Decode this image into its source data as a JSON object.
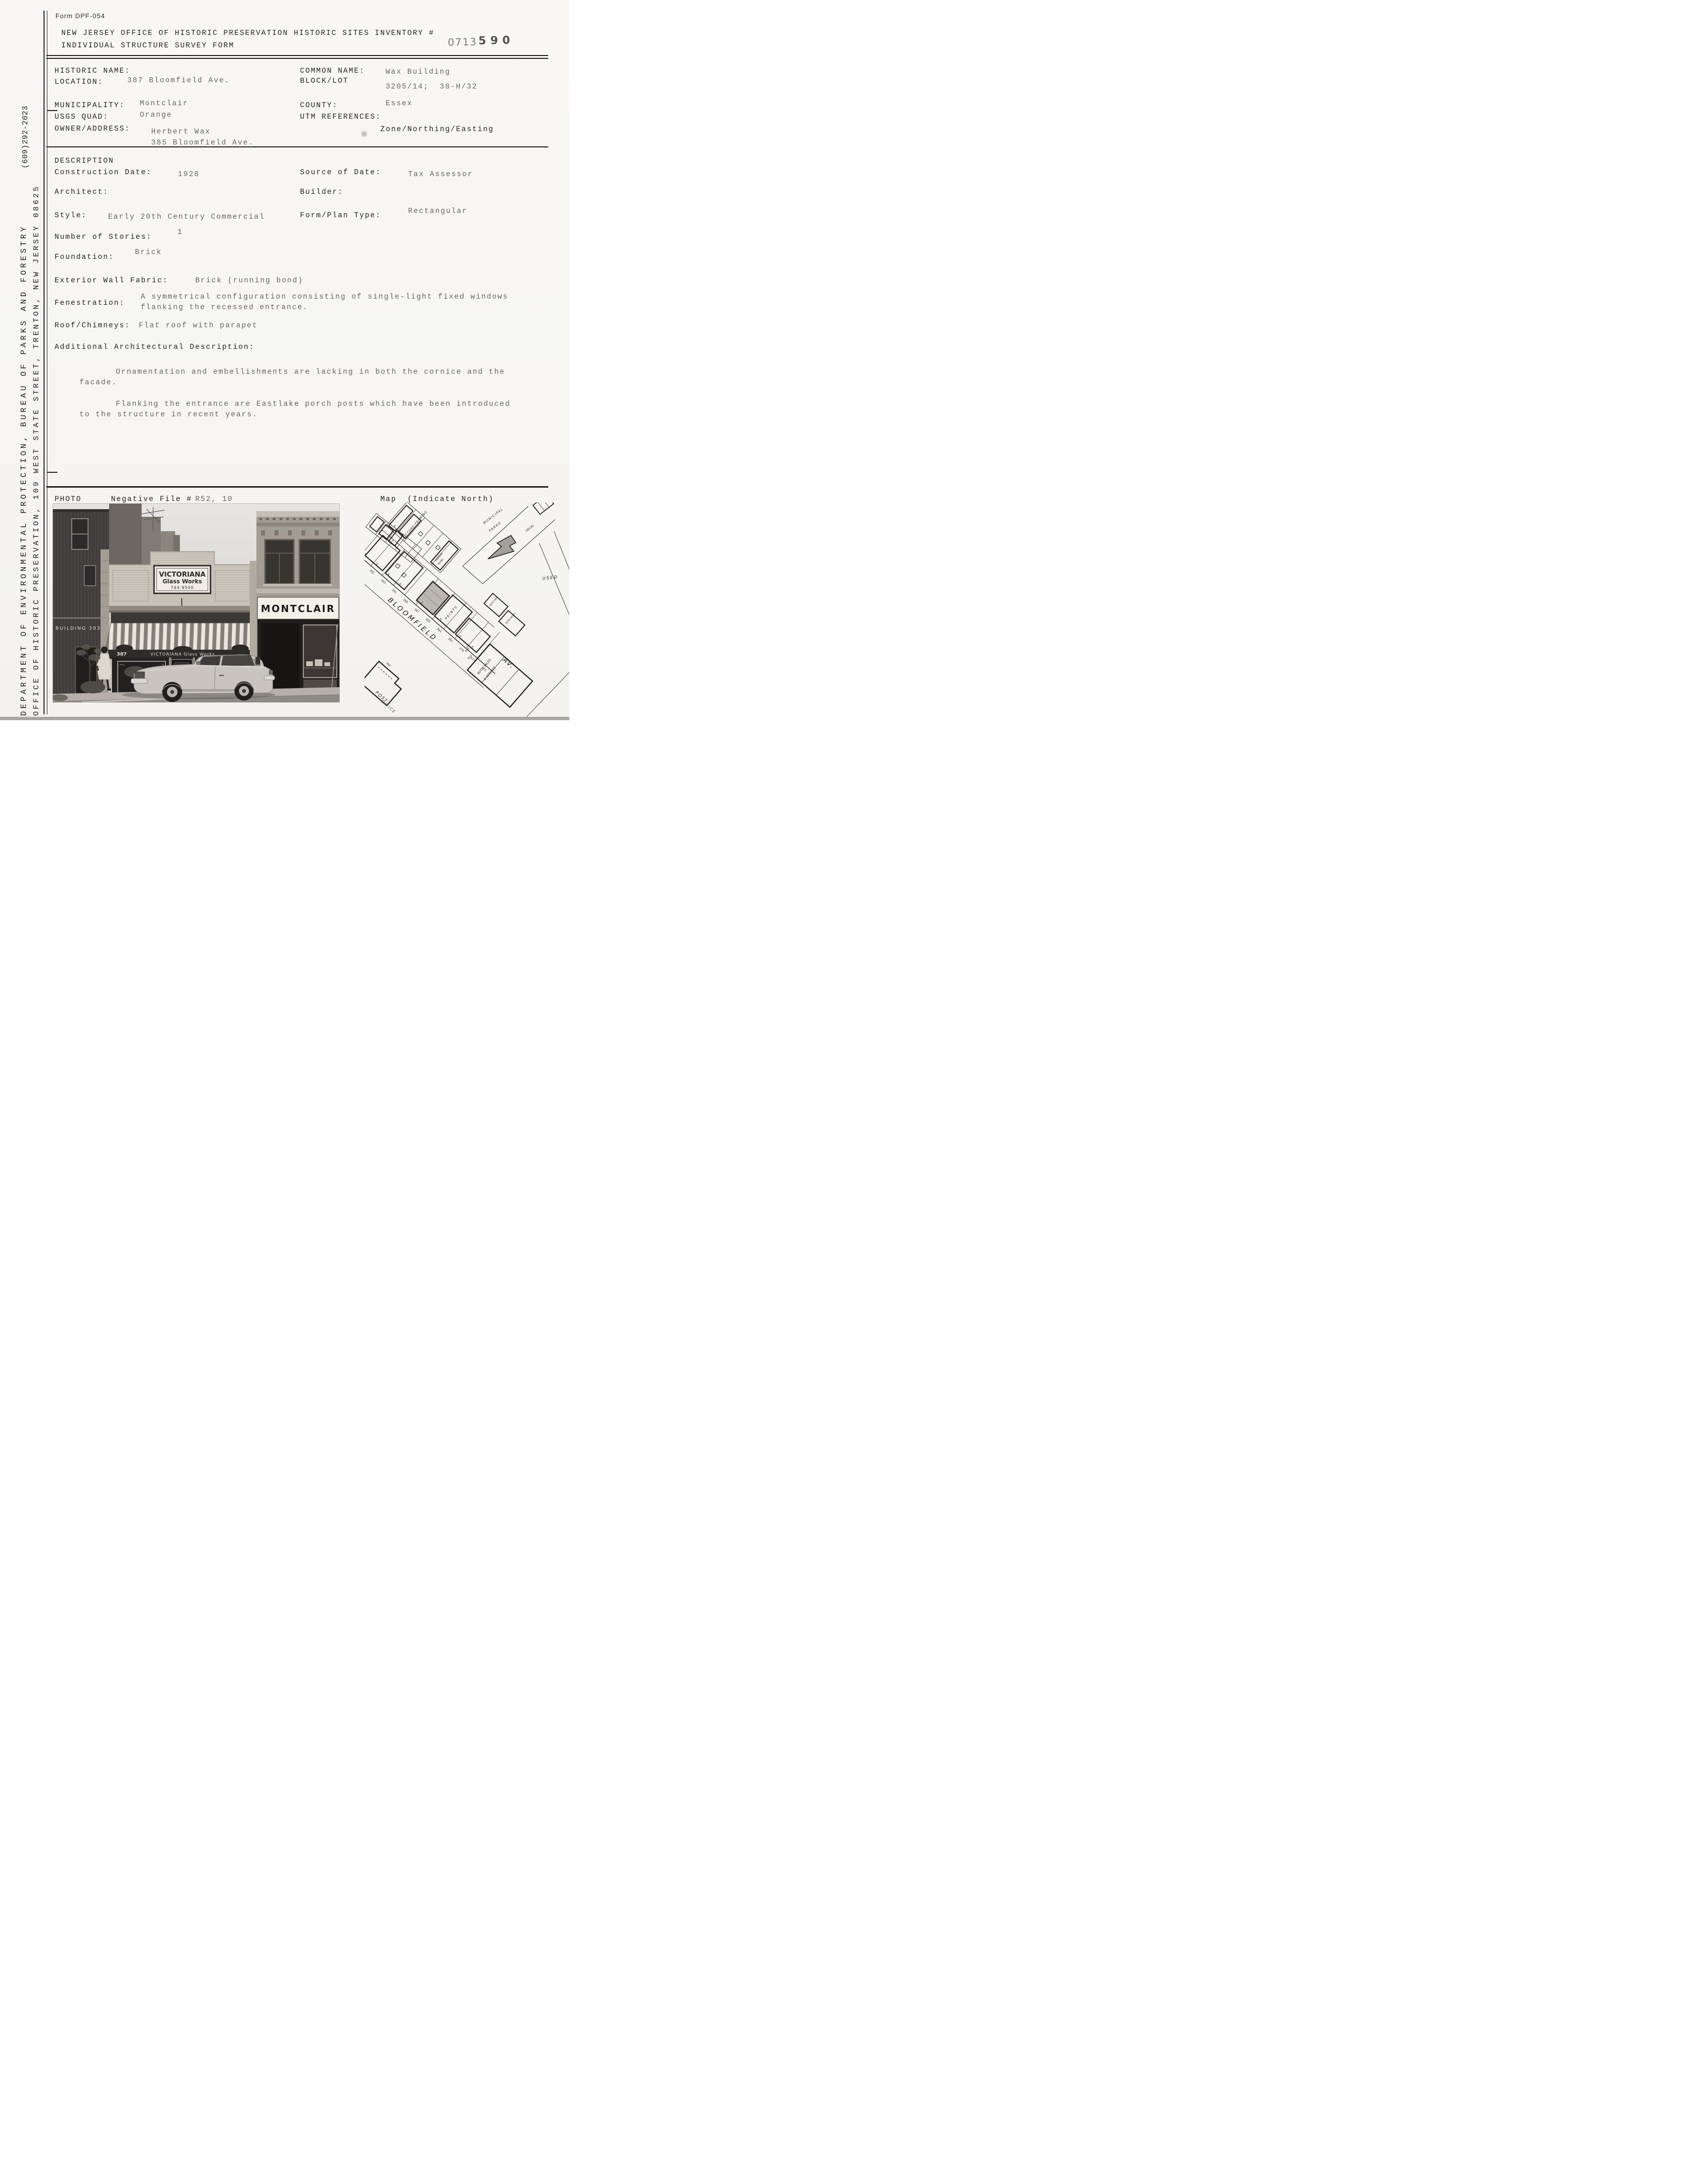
{
  "theme": {
    "paper": "#f7f6f2",
    "ink": "#26241f",
    "value_ink": "#68665f",
    "stamp_gray": "#7d7b76"
  },
  "header": {
    "form_number": "Form DPF-054",
    "title_line1": "NEW JERSEY OFFICE OF HISTORIC PRESERVATION HISTORIC SITES INVENTORY #",
    "title_line2": "INDIVIDUAL STRUCTURE SURVEY FORM",
    "inventory_stamp": "0713",
    "inventory_number_handwritten": "590"
  },
  "sidebar": {
    "department_line": "DEPARTMENT OF ENVIRONMENTAL PROTECTION, BUREAU OF PARKS AND FORESTRY",
    "office_line": "OFFICE OF HISTORIC PRESERVATION, 109 WEST STATE STREET, TRENTON, NEW JERSEY 08625",
    "phone": "(609)292-2023"
  },
  "identification": {
    "historic_name_label": "HISTORIC NAME:",
    "location_label": "LOCATION:",
    "location_value": "387 Bloomfield Ave.",
    "common_name_label": "COMMON NAME:",
    "common_name_value": "Wax Building",
    "block_lot_label": "BLOCK/LOT",
    "block_lot_value": "3205/14;  38-H/32",
    "municipality_label": "MUNICIPALITY:",
    "municipality_value": "Montclair",
    "county_label": "COUNTY:",
    "county_value": "Essex",
    "usgs_quad_label": "USGS QUAD:",
    "usgs_quad_value": "Orange",
    "utm_label": "UTM REFERENCES:",
    "utm_value": "Zone/Northing/Easting",
    "owner_label": "OWNER/ADDRESS:",
    "owner_value_line1": "Herbert Wax",
    "owner_value_line2": "385 Bloomfield Ave."
  },
  "description": {
    "section_title": "DESCRIPTION",
    "construction_date_label": "Construction Date:",
    "construction_date_value": "1928",
    "source_of_date_label": "Source of Date:",
    "source_of_date_value": "Tax Assessor",
    "architect_label": "Architect:",
    "builder_label": "Builder:",
    "style_label": "Style:",
    "style_value": "Early 20th Century Commercial",
    "form_plan_label": "Form/Plan Type:",
    "form_plan_value": "Rectangular",
    "stories_label": "Number of Stories:",
    "stories_value": "1",
    "foundation_label": "Foundation:",
    "foundation_value": "Brick",
    "wall_fabric_label": "Exterior Wall Fabric:",
    "wall_fabric_value": "Brick (running bond)",
    "fenestration_label": "Fenestration:",
    "fenestration_value_line1": "A symmetrical configuration consisting of single-light fixed windows",
    "fenestration_value_line2": "flanking the recessed entrance.",
    "roof_label": "Roof/Chimneys:",
    "roof_value": "Flat roof with parapet",
    "additional_label": "Additional Architectural Description:",
    "additional_para1_line1": "Ornamentation and embellishments are lacking in both the cornice and the",
    "additional_para1_line2": "facade.",
    "additional_para2_line1": "Flanking the entrance are Eastlake porch posts which have been introduced",
    "additional_para2_line2": "to the structure in recent years."
  },
  "photo_section": {
    "photo_label": "PHOTO",
    "negative_file_label": "Negative File #",
    "negative_file_value": "R52, 10",
    "map_label": "Map  (Indicate North)"
  },
  "photo": {
    "building_left_sign": "BUILDING 393",
    "parapet_sign_line1": "VICTORIANA",
    "parapet_sign_line2": "Glass Works",
    "parapet_sign_line3": "744·9500",
    "awning_number": "387",
    "awning_text": "VICTORIANA Glass Works",
    "montclair_sign": "MONTCLAIR"
  },
  "map": {
    "street_label_1": "BLOOMFIELD",
    "street_label_2": "AV.",
    "municipal_line1": "MUNICIPAL",
    "municipal_line2": "PARKG",
    "picture_framing": "PICTURE FRAMING",
    "hardware_line1": "HARDW",
    "hardware_line2": "W.HO",
    "paints": "PAINTS",
    "used": "USED",
    "auto_rep": "AUTO REP",
    "auto_body": "AUTO BODY",
    "auto_sales_line1": "AUTO SALES",
    "auto_sales_line2": "& SERVICE",
    "tile": "TILE",
    "post_line1": "POST",
    "post_line2": "OFFICE",
    "number_392": "392",
    "number_18cb": "18(CB)",
    "s_mark": "S",
    "lot_numbers": [
      "397",
      "395",
      "393",
      "391",
      "389",
      "387",
      "385",
      "383",
      "381",
      "379",
      "377",
      "375"
    ]
  }
}
